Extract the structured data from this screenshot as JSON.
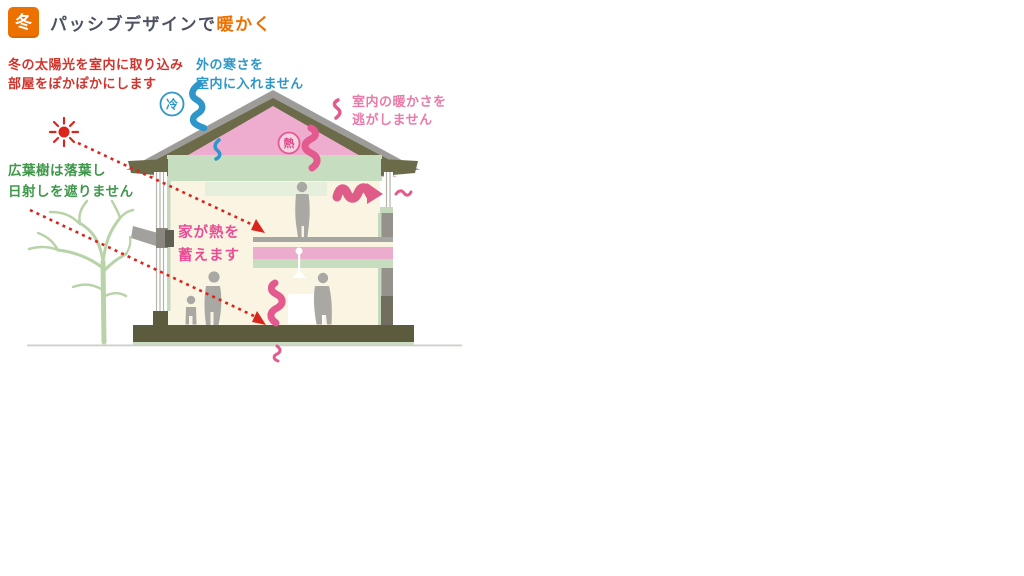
{
  "header": {
    "badge": "冬",
    "title": {
      "main": "パッシブデザインで",
      "accent": "暖かく"
    }
  },
  "annotations": {
    "sunlight": {
      "line1": "冬の太陽光を室内に取り込み",
      "line2": "部屋をぽかぽかにします",
      "color": "#d0342c"
    },
    "cold_block": {
      "line1": "外の寒さを",
      "line2": "室内に入れません",
      "color": "#2e96c8"
    },
    "keep_warmth": {
      "line1": "室内の暖かさを",
      "line2": "逃がしません",
      "color": "#e87ba8"
    },
    "deciduous": {
      "line1": "広葉樹は落葉し",
      "line2": "日射しを遮りません",
      "color": "#3f984a"
    },
    "heat_storage": {
      "line1": "家が熱を",
      "line2": "蓄えます",
      "color": "#ea4d96"
    }
  },
  "badges": {
    "cold": "冷",
    "heat": "熱"
  },
  "colors": {
    "accent_orange": "#ed7100",
    "sun_red": "#da251d",
    "cold_blue": "#2e96c8",
    "heat_pink": "#e4598e",
    "roof_pink": "#eeadce",
    "insulation_green": "#c7ddbf",
    "structure_olive": "#6b6a49",
    "foundation_olive": "#5c5b3e",
    "interior_cream": "#faf4e3",
    "roof_gray": "#9d9c98",
    "silhouette_gray": "#a9a8a3"
  }
}
